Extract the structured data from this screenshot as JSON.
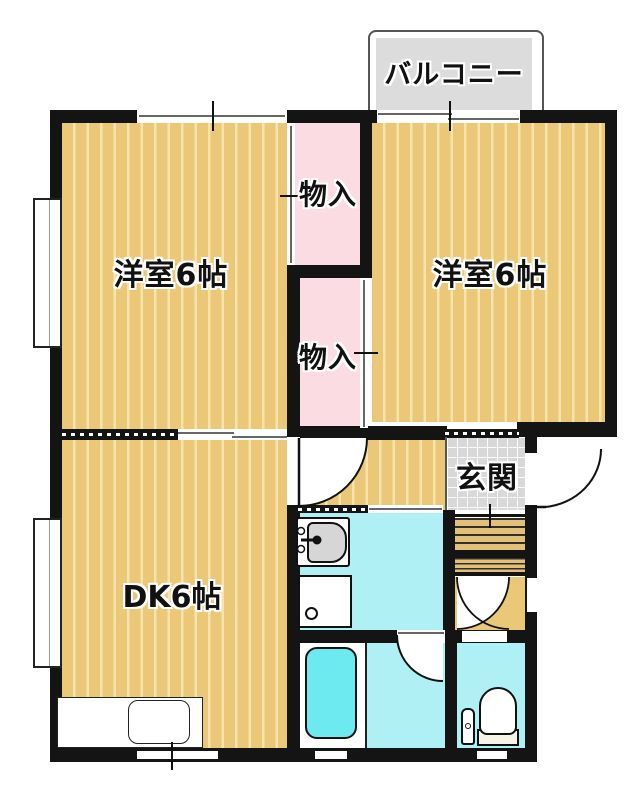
{
  "labels": {
    "balcony": "バルコニー",
    "room_left": "洋室6帖",
    "room_right": "洋室6帖",
    "closet_top": "物入",
    "closet_bottom": "物入",
    "genkan": "玄関",
    "dk": "DK6帖"
  },
  "colors": {
    "wall": "#141414",
    "floor-tan": "#ebc778",
    "floor-stripe": "#f7e4ad",
    "closet-pink": "#fbdce2",
    "water-cyan": "#aef0f3",
    "tub-cyan": "#6ceaf0",
    "balcony-gray": "#dcdcdc",
    "genkan-gray": "#d8d8d8",
    "line": "#111111"
  },
  "fixtures": {
    "bathtub": "bathtub",
    "toilet": "toilet",
    "washbasin": "washbasin",
    "washing_machine_pan": "washing-machine-pan",
    "kitchen_sink": "kitchen-sink",
    "entrance_steps": "entrance-steps"
  }
}
